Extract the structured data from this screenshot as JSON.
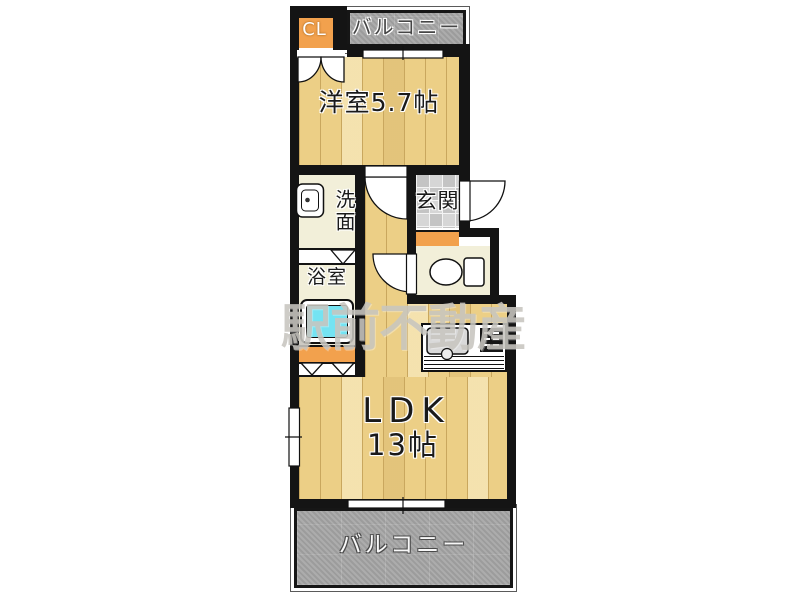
{
  "plan": {
    "watermark": "駅前不動産",
    "rooms": {
      "closet": "CL",
      "balcony_top": "バルコニー",
      "western_room": "洋室5.7帖",
      "washroom": "洗面",
      "entrance": "玄関",
      "bathroom": "浴室",
      "ldk_line1": "LDK",
      "ldk_line2": "13帖",
      "balcony_bottom": "バルコニー"
    },
    "colors": {
      "wall": "#141414",
      "wood": "#eccf86",
      "wood_line": "#c9a75e",
      "orange": "#f2a14d",
      "balcony": "#a6a6a6",
      "cream": "#f2efd9",
      "tile": "#d6d6d6",
      "tile_alt": "#c4c4c4",
      "bathtub": "#74e3f2",
      "watermark": "#c8c6c0"
    }
  }
}
